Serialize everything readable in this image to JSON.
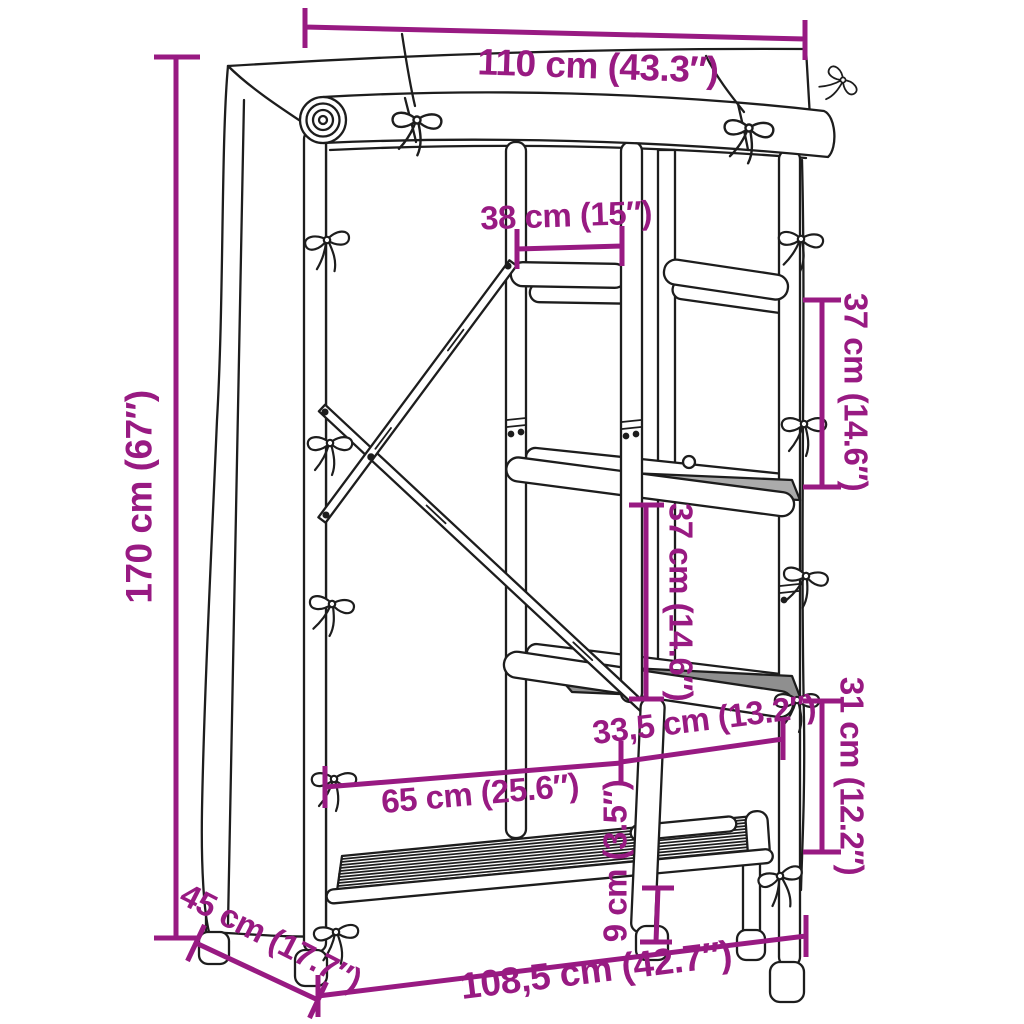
{
  "colors": {
    "dimension_text": "#981a82",
    "line_art": "#1d1d1d",
    "background": "#ffffff"
  },
  "diagram": {
    "dimensions": {
      "top_width": "110 cm (43.3″)",
      "upper_shelf_width": "38 cm (15″)",
      "total_height": "170 cm (67″)",
      "upper_shelf_gap": "37 cm (14.6″)",
      "middle_shelf_gap": "37 cm (14.6″)",
      "lower_right_gap": "31 cm (12.2″)",
      "shelf_section_width": "33,5 cm (13.2″)",
      "hanging_section_width": "65 cm (25.6″)",
      "base_clearance": "9 cm (3.5″)",
      "depth": "45 cm (17.7″)",
      "bottom_width": "108,5 cm (42.7″)"
    }
  }
}
